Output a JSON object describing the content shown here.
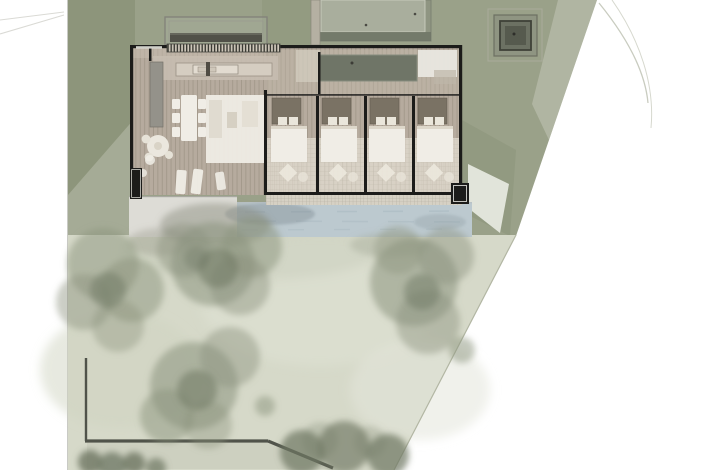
{
  "meta": {
    "title": "Villa site plan rendering",
    "view": "top-down architectural site plan, watercolor render style",
    "canvas": {
      "width": 726,
      "height": 470
    },
    "visible_text": "none"
  },
  "palette": {
    "background": "#ffffff",
    "terrain": "#9aa189",
    "terrain_dark": "#7f8a6d",
    "terrain_fade": "#c3c7b6",
    "lawn": "#d6d9c9",
    "road": "#cdd0c3",
    "wall": "#1c1c1a",
    "wood_deck": "#b6ab9e",
    "pool_water": "#bcc9cf",
    "pool_deck": "#dddcd6",
    "grid_strip": "#d6d1c4",
    "tile_floor": "#e3ddd1",
    "tree_canopy": "#8b937e",
    "tree_canopy_dark": "#6e7763",
    "courtyard": "#6f7567",
    "bed_headboard": "#7a7264",
    "furniture_white": "#f0ede6",
    "structure_gray": "#8f9582",
    "boundary_wall": "#50534a"
  },
  "features": {
    "building": {
      "bedrooms": 4,
      "living_dining_kitchen": true,
      "wood_deck": true,
      "dark_courtyard_patio": true
    },
    "swimming_pool": true,
    "pool_side_deck": true,
    "trellis_canopy": true,
    "garage_roof": true,
    "well_pavilion": true,
    "boundary_wall": true,
    "large_tree_clusters": 5,
    "hedges_at_boundary": true
  }
}
